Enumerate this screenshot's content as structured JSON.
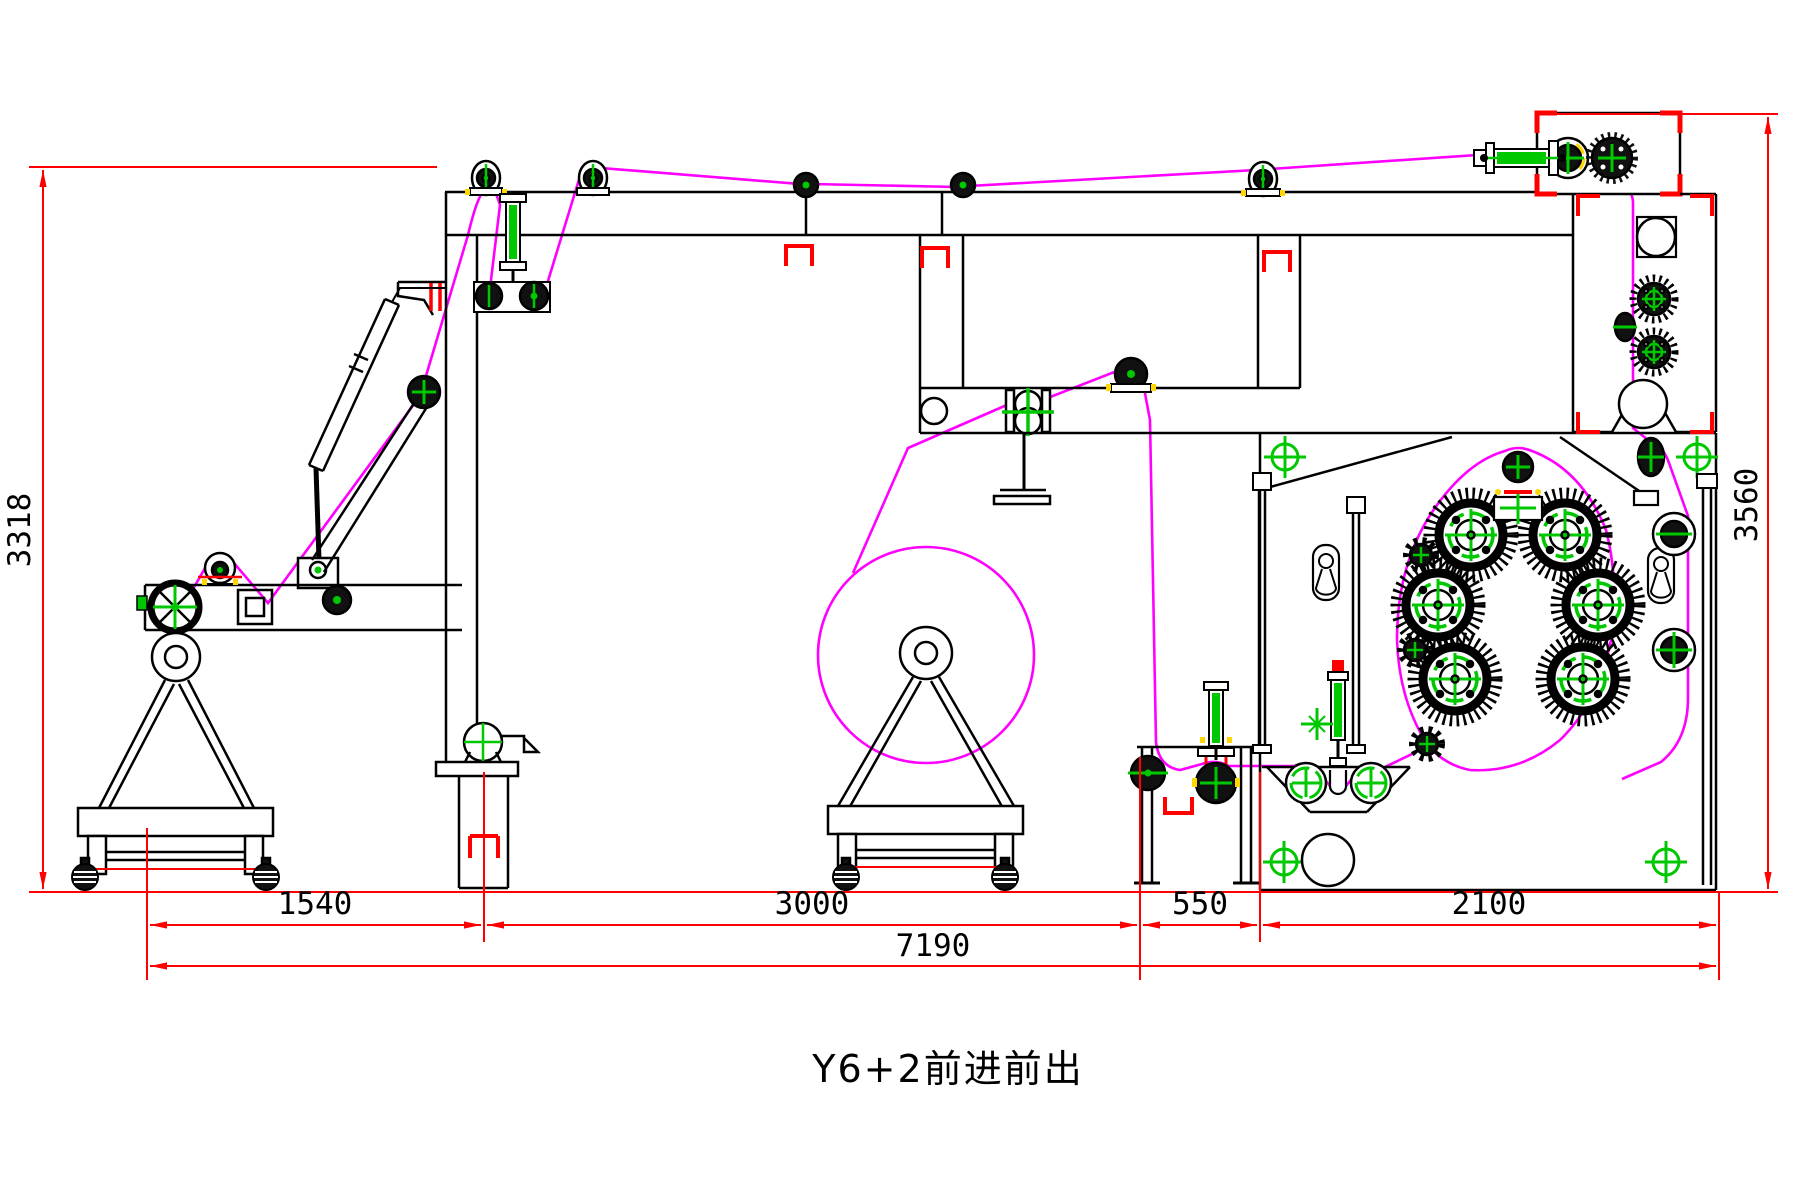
{
  "drawing": {
    "title": "Y6+2前进前出",
    "dimensions": {
      "bottom": [
        {
          "id": "d1540",
          "value": "1540"
        },
        {
          "id": "d3000",
          "value": "3000"
        },
        {
          "id": "d550",
          "value": "550"
        },
        {
          "id": "d2100",
          "value": "2100"
        }
      ],
      "bottom_total": {
        "value": "7190"
      },
      "left_height": {
        "value": "3318"
      },
      "right_height": {
        "value": "3560"
      }
    },
    "colors": {
      "dimension_lines": "#FF0000",
      "web_path": "#FF00FF",
      "machine_lines": "#000000",
      "component_accent": "#00C800",
      "tick_accent": "#FFD700",
      "background": "#FFFFFF"
    }
  }
}
